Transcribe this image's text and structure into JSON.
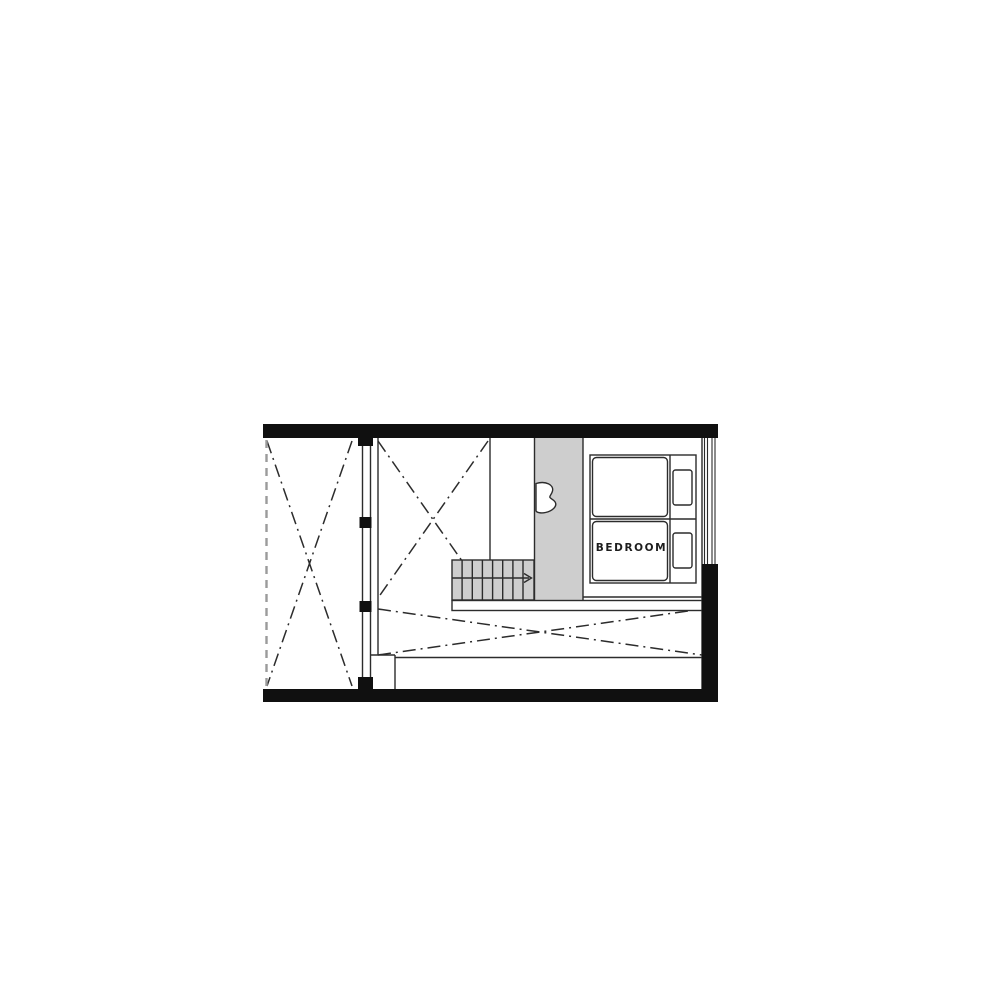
{
  "plan": {
    "type": "floor-plan",
    "room_label": "BEDROOM"
  },
  "icons": {
    "stair_arrow": "stair-direction-arrow",
    "door": "door-swing",
    "void_marks": "void-cross",
    "window_wall": "window-mullion"
  },
  "colors": {
    "wall": "#101010",
    "line": "#2c2c2c",
    "fill-gray": "#cecece",
    "dash-gray": "#9b9b9b",
    "label": "#1d1d1d",
    "background": "#ffffff"
  }
}
